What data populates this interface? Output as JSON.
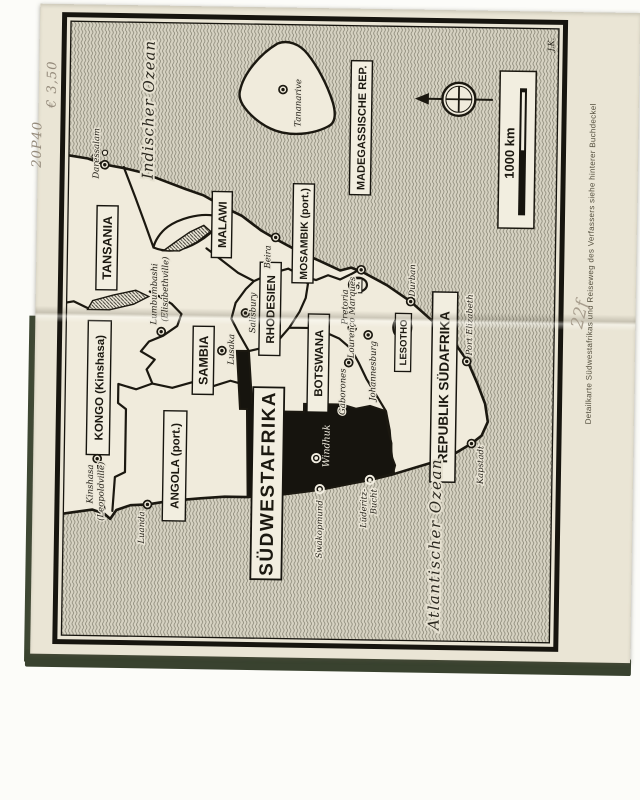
{
  "annotations": {
    "price_note_1": "20P40",
    "price_note_2": "€ 3,50",
    "page_ref": "22f",
    "margin_caption": "Detailkarte Südwestafrikas und Reiseweg des Verfassers siehe hinterer Buchdeckel",
    "cartographer_mark": "J.K."
  },
  "map": {
    "scale_label": "1000 km",
    "region_highlight": "SÜDWESTAFRIKA",
    "oceans": {
      "indian": "Indischer Ozean",
      "atlantic": "Atlantischer Ozean"
    },
    "countries": {
      "tansania": "TANSANIA",
      "kongo": "KONGO (Kinshasa)",
      "angola": "ANGOLA (port.)",
      "sambia": "SAMBIA",
      "malawi": "MALAWI",
      "mosambik": "MOSAMBIK (port.)",
      "madagaskar": "MADEGASSISCHE REP.",
      "rhodesien": "RHODESIEN",
      "botswana": "BOTSWANA",
      "lesotho": "LESOTHO",
      "swasiland": "S.",
      "suedafrika": "REPUBLIK SÜDAFRIKA"
    },
    "cities": {
      "daressalam": "Daressalam",
      "tananarive": "Tananarive",
      "beira": "Beira",
      "lourenco_marques": "Lourenço Marques",
      "durban": "Durban",
      "salisbury": "Salisbury",
      "lusaka": "Lusaka",
      "lumbumbashi_1": "Lumbumbashi",
      "lumbumbashi_2": "(Elisabethville)",
      "kinshasa_1": "Kinshasa",
      "kinshasa_2": "(Leopoldville)",
      "luanda": "Luanda",
      "windhuk": "Windhuk",
      "swakopmund": "Swakopmund",
      "luederitz_1": "Lüderitz-",
      "luederitz_2": "Bucht",
      "kapstadt": "Kapstadt",
      "port_elizabeth": "Port Elizabeth",
      "pretoria": "Pretoria",
      "johannesburg": "Johannesburg",
      "gaborones": "Gaborones"
    },
    "colors": {
      "ink": "#1b1810",
      "paper": "#eae5d5",
      "land": "#f0ebdc",
      "swa_fill": "#16140e",
      "cover_green": "#3d4734",
      "pencil": "#958b7c"
    }
  }
}
